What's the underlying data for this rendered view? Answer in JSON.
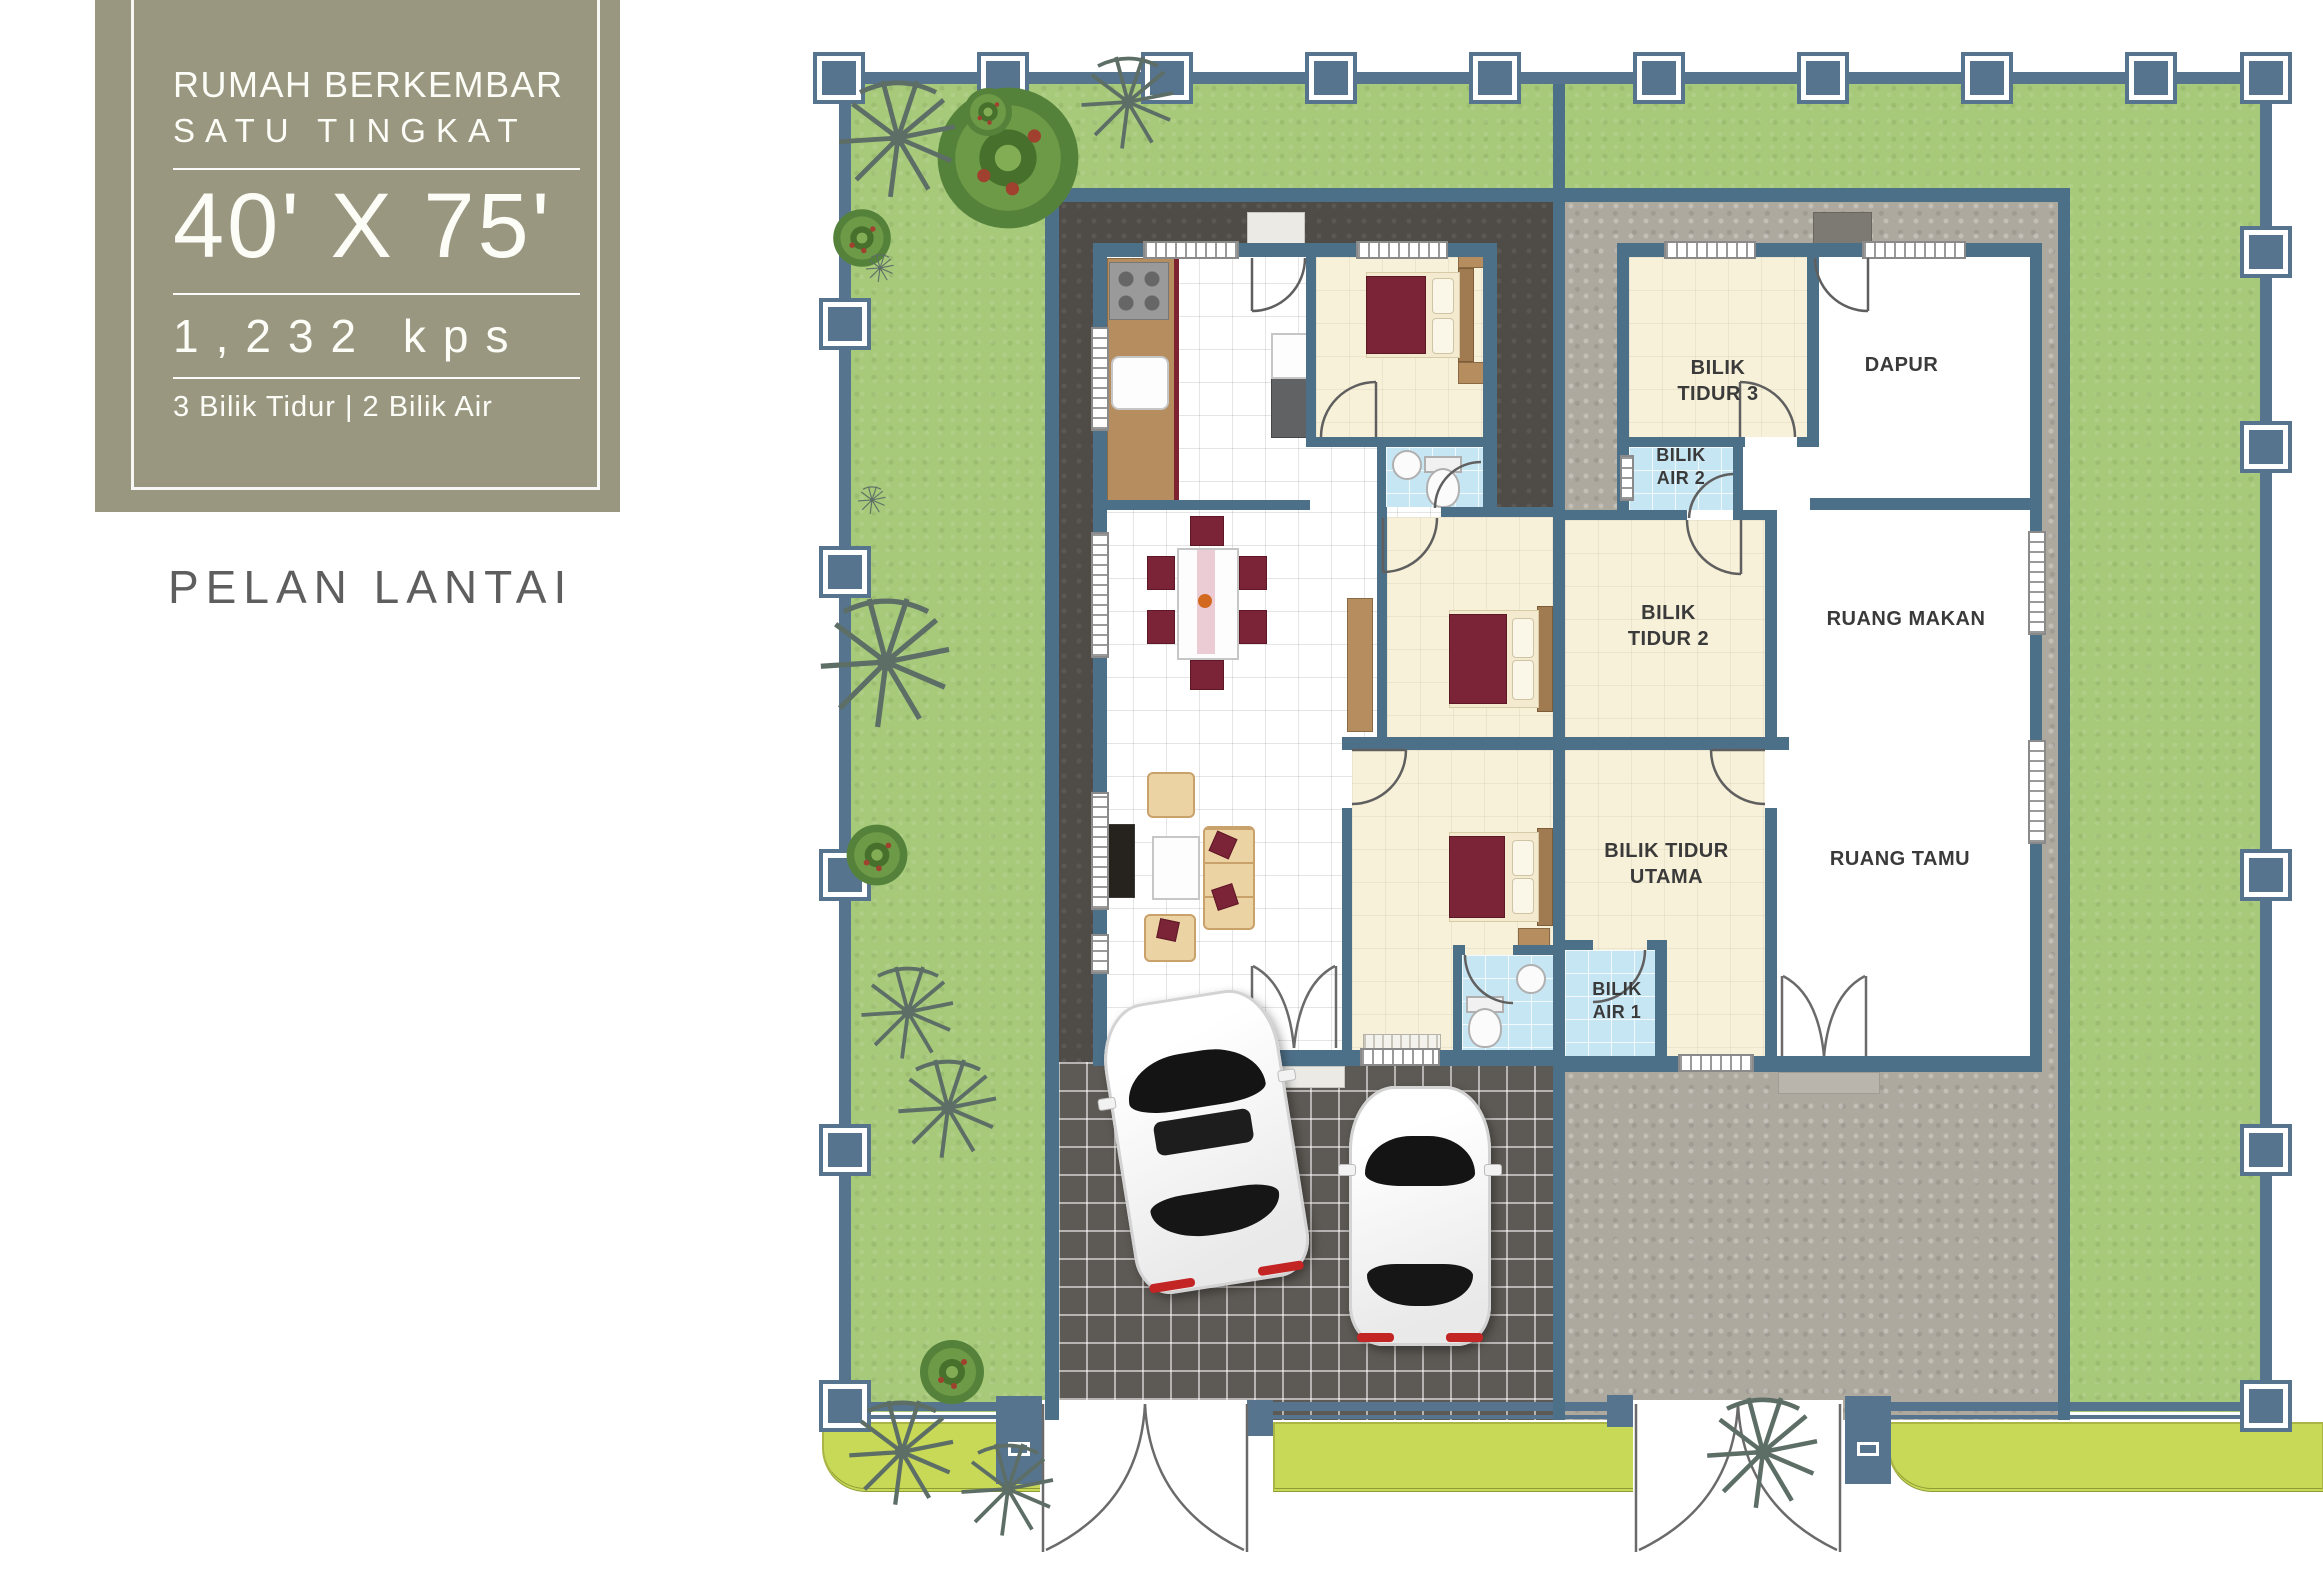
{
  "panel": {
    "title_line1": "RUMAH BERKEMBAR",
    "title_line2": "SATU TINGKAT",
    "dimensions": "40' X 75'",
    "area": "1,232 kps",
    "features": "3 Bilik Tidur | 2 Bilik Air",
    "caption": "PELAN LANTAI"
  },
  "rooms": {
    "bilik_tidur_3": "BILIK\nTIDUR 3",
    "dapur": "DAPUR",
    "bilik_air_2": "BILIK\nAIR 2",
    "bilik_tidur_2": "BILIK\nTIDUR 2",
    "ruang_makan": "RUANG MAKAN",
    "bilik_tidur_utama": "BILIK TIDUR\nUTAMA",
    "ruang_tamu": "RUANG TAMU",
    "bilik_air_1": "BILIK\nAIR 1"
  },
  "colors": {
    "info_box": "#9a9781",
    "text_light": "#fdfdf8",
    "text_dark": "#3a3a3a",
    "caption": "#5e5e5e",
    "lawn": "#a7c97a",
    "lime": "#c8d957",
    "fence": "#57748e",
    "wall": "#4d7089",
    "apron_dark": "#4f4b47",
    "apron_light": "#ada99f",
    "tile_dark": "#5d5954",
    "floor_white": "#ffffff",
    "cream": "#f8f1d9",
    "bath": "#c7e6f4",
    "maroon": "#7b2337",
    "wood": "#b68d5e",
    "wood_dark": "#a07a50",
    "tan": "#ecd3a4",
    "step": "#eceae5",
    "car_body": "#f7f7f7"
  }
}
